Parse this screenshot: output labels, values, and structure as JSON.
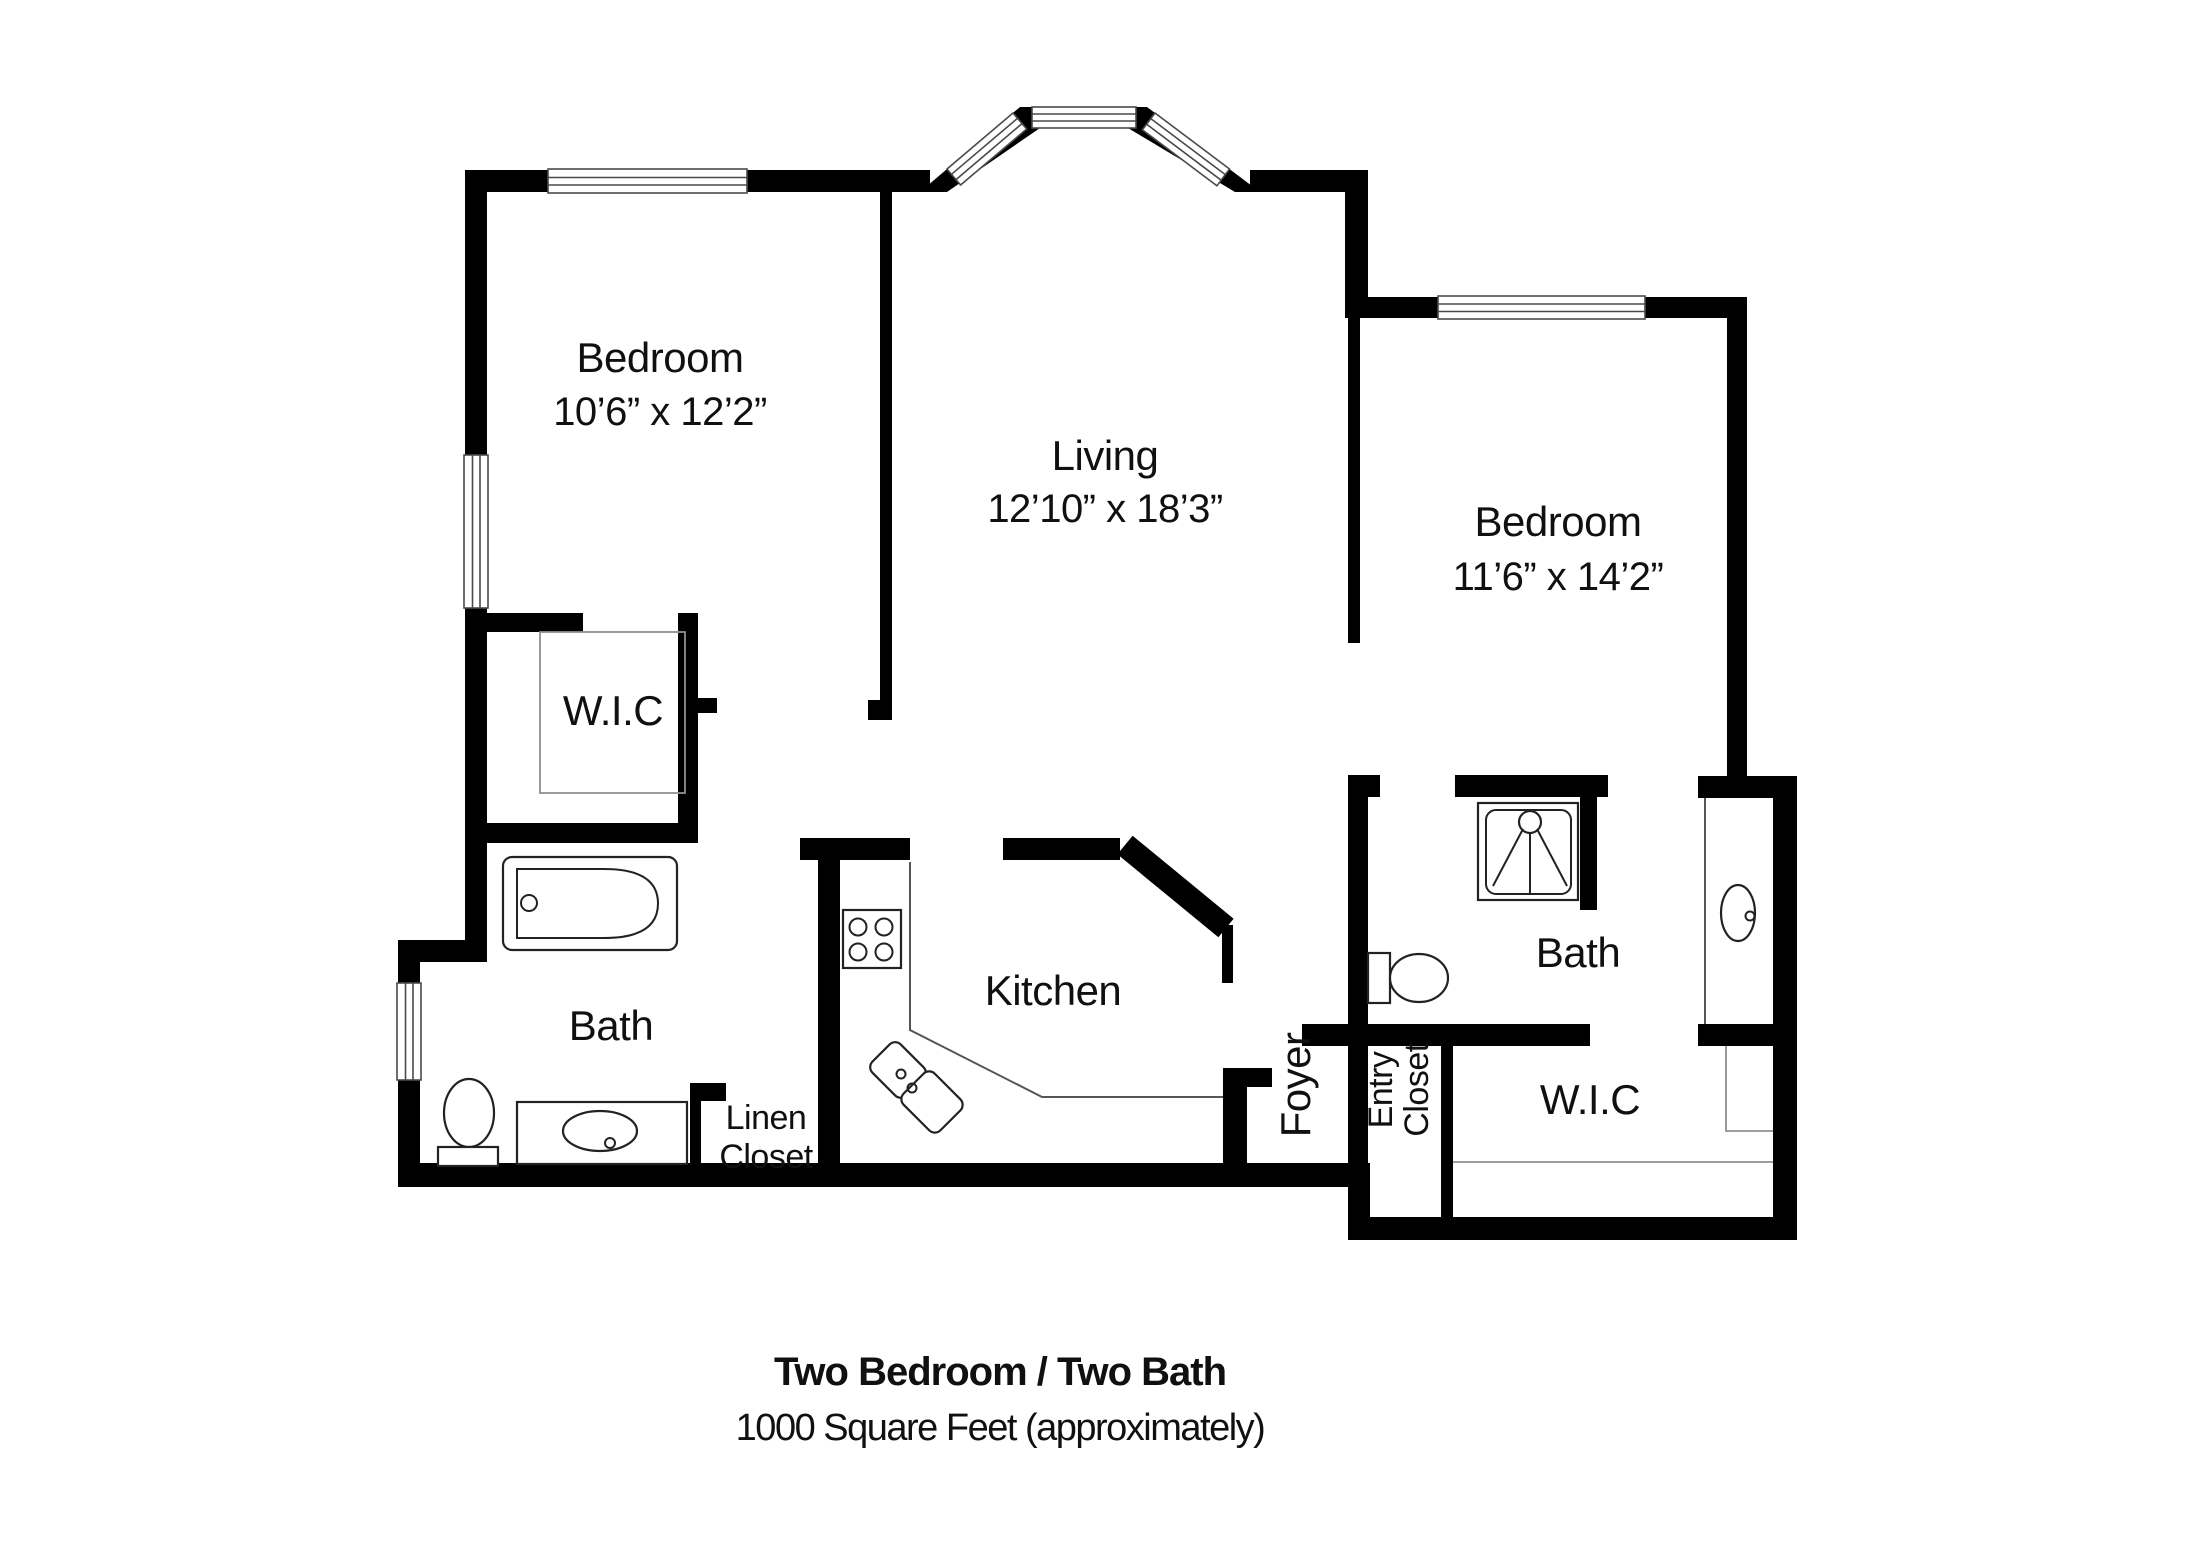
{
  "floorplan": {
    "rooms": {
      "bedroom1": {
        "name": "Bedroom",
        "dims": "10’6” x 12’2”"
      },
      "living": {
        "name": "Living",
        "dims": "12’10” x 18’3”"
      },
      "bedroom2": {
        "name": "Bedroom",
        "dims": "11’6” x 14’2”"
      },
      "wic1": {
        "name": "W.I.C"
      },
      "wic2": {
        "name": "W.I.C"
      },
      "bath1": {
        "name": "Bath"
      },
      "bath2": {
        "name": "Bath"
      },
      "kitchen": {
        "name": "Kitchen"
      },
      "foyer": {
        "name": "Foyer"
      },
      "linen_closet": {
        "line1": "Linen",
        "line2": "Closet"
      },
      "entry_closet": {
        "line1": "Entry",
        "line2": "Closet"
      }
    },
    "title": {
      "line1": "Two Bedroom / Two Bath",
      "line2": "1000 Square Feet (approximately)"
    },
    "colors": {
      "walls": "#000000",
      "background": "#ffffff",
      "fixtures": "#222222",
      "guides": "#909090"
    }
  }
}
